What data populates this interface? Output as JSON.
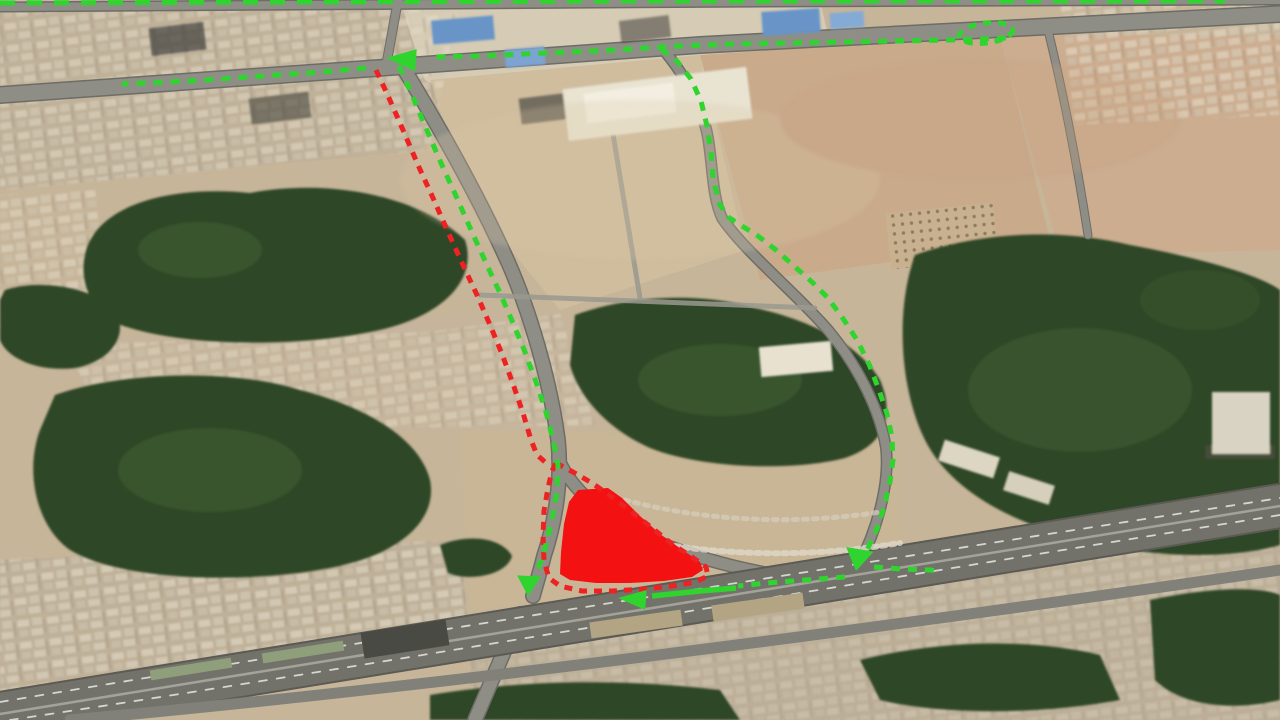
{
  "map_view": {
    "kind": "aerial-satellite-traffic-diversion-map",
    "annotations": {
      "palette": {
        "detour": "#2fd42f",
        "closed": "#ee2222",
        "closure_fill": "#f31111"
      },
      "routes": [
        {
          "id": "detour-top-edge-route",
          "color": "detour",
          "width": 5,
          "dash": [
            15,
            12
          ],
          "points": [
            [
              0,
              3
            ],
            [
              320,
              2
            ],
            [
              640,
              1
            ],
            [
              960,
              1
            ],
            [
              1225,
              1
            ]
          ]
        },
        {
          "id": "detour-westbound-approach",
          "color": "detour",
          "width": 5,
          "dash": [
            9,
            8
          ],
          "points": [
            [
              1006,
              38
            ],
            [
              952,
              40
            ],
            [
              898,
              41
            ],
            [
              845,
              42
            ],
            [
              790,
              43
            ],
            [
              735,
              44
            ],
            [
              680,
              46
            ],
            [
              660,
              47
            ],
            [
              615,
              50
            ],
            [
              570,
              52
            ],
            [
              525,
              54
            ],
            [
              480,
              56
            ],
            [
              432,
              57
            ]
          ]
        },
        {
          "id": "detour-westbound-exit",
          "color": "detour",
          "width": 5,
          "dash": [
            9,
            8
          ],
          "points": [
            [
              366,
              68
            ],
            [
              322,
              72
            ],
            [
              278,
              75
            ],
            [
              234,
              78
            ],
            [
              190,
              81
            ],
            [
              146,
              83
            ],
            [
              122,
              84
            ]
          ]
        },
        {
          "id": "detour-eastern-bypass",
          "color": "detour",
          "width": 5,
          "dash": [
            9,
            8
          ],
          "points": [
            [
              661,
              49
            ],
            [
              677,
              61
            ],
            [
              691,
              79
            ],
            [
              701,
              101
            ],
            [
              707,
              126
            ],
            [
              711,
              152
            ],
            [
              713,
              178
            ],
            [
              719,
              203
            ],
            [
              728,
              217
            ],
            [
              742,
              226
            ],
            [
              758,
              236
            ],
            [
              776,
              250
            ],
            [
              794,
              266
            ],
            [
              812,
              282
            ],
            [
              827,
              297
            ],
            [
              842,
              317
            ],
            [
              857,
              340
            ],
            [
              869,
              364
            ],
            [
              879,
              390
            ],
            [
              887,
              414
            ],
            [
              892,
              437
            ],
            [
              893,
              460
            ],
            [
              890,
              482
            ],
            [
              884,
              507
            ],
            [
              877,
              529
            ],
            [
              867,
              550
            ],
            [
              860,
              561
            ]
          ]
        },
        {
          "id": "detour-frontage-west",
          "color": "detour",
          "width": 5,
          "dash": [
            9,
            8
          ],
          "points": [
            [
              845,
              577
            ],
            [
              806,
              580
            ],
            [
              767,
              583
            ],
            [
              738,
              586
            ]
          ]
        },
        {
          "id": "detour-frontage-arrow-shaft",
          "color": "detour",
          "width": 5.5,
          "dash": null,
          "points": [
            [
              736,
              588
            ],
            [
              700,
              591
            ],
            [
              652,
              596
            ]
          ]
        },
        {
          "id": "detour-highway-east-stub",
          "color": "detour",
          "width": 5,
          "dash": [
            9,
            8
          ],
          "points": [
            [
              874,
              567
            ],
            [
              902,
              569
            ],
            [
              930,
              570
            ],
            [
              938,
              571
            ]
          ]
        },
        {
          "id": "detour-closed-road-southbound",
          "color": "detour",
          "width": 5,
          "dash": [
            9,
            8
          ],
          "points": [
            [
              399,
              66
            ],
            [
              412,
              95
            ],
            [
              426,
              128
            ],
            [
              441,
              163
            ],
            [
              456,
              196
            ],
            [
              471,
              230
            ],
            [
              486,
              263
            ],
            [
              500,
              293
            ],
            [
              513,
              323
            ],
            [
              525,
              352
            ],
            [
              536,
              382
            ],
            [
              546,
              412
            ],
            [
              553,
              440
            ],
            [
              558,
              465
            ],
            [
              557,
              492
            ],
            [
              552,
              520
            ],
            [
              545,
              548
            ],
            [
              538,
              570
            ],
            [
              534,
              581
            ]
          ]
        },
        {
          "id": "closed-road-route",
          "color": "closed",
          "width": 5,
          "dash": [
            8,
            7
          ],
          "points": [
            [
              376,
              70
            ],
            [
              389,
              98
            ],
            [
              403,
              130
            ],
            [
              418,
              165
            ],
            [
              433,
              198
            ],
            [
              448,
              232
            ],
            [
              463,
              265
            ],
            [
              477,
              295
            ],
            [
              490,
              325
            ],
            [
              502,
              354
            ],
            [
              513,
              384
            ],
            [
              523,
              413
            ],
            [
              531,
              440
            ],
            [
              537,
              455
            ],
            [
              545,
              462
            ]
          ]
        },
        {
          "id": "closure-zone-perimeter",
          "color": "closed",
          "width": 5,
          "dash": [
            8,
            7
          ],
          "closed": true,
          "points": [
            [
              556,
              463
            ],
            [
              573,
              472
            ],
            [
              592,
              483
            ],
            [
              612,
              497
            ],
            [
              633,
              513
            ],
            [
              652,
              528
            ],
            [
              672,
              544
            ],
            [
              692,
              557
            ],
            [
              706,
              567
            ],
            [
              708,
              576
            ],
            [
              695,
              582
            ],
            [
              672,
              586
            ],
            [
              645,
              589
            ],
            [
              612,
              591
            ],
            [
              582,
              591
            ],
            [
              560,
              586
            ],
            [
              549,
              578
            ],
            [
              544,
              561
            ],
            [
              543,
              536
            ],
            [
              544,
              511
            ],
            [
              548,
              488
            ],
            [
              552,
              471
            ]
          ]
        }
      ],
      "closure_area": {
        "id": "closed-zone-fill",
        "color": "closure_fill",
        "points": [
          [
            578,
            490
          ],
          [
            608,
            488
          ],
          [
            622,
            498
          ],
          [
            640,
            516
          ],
          [
            660,
            534
          ],
          [
            684,
            551
          ],
          [
            700,
            562
          ],
          [
            703,
            570
          ],
          [
            692,
            577
          ],
          [
            664,
            581
          ],
          [
            630,
            583
          ],
          [
            596,
            583
          ],
          [
            570,
            580
          ],
          [
            560,
            574
          ],
          [
            561,
            552
          ],
          [
            564,
            524
          ],
          [
            569,
            502
          ]
        ]
      },
      "uturn_loop": {
        "id": "u-turn-loop",
        "color": "detour",
        "width": 5,
        "dash": [
          8,
          7
        ],
        "cx": 986,
        "cy": 33,
        "rx": 27,
        "ry": 10,
        "rotate": -7
      },
      "arrows": [
        {
          "id": "arrow-west-top-intersection",
          "color": "detour",
          "x": 386,
          "y": 58,
          "angle": 184,
          "len": 30,
          "halfwidth": 11
        },
        {
          "id": "arrow-south-bottom-junction",
          "color": "detour",
          "x": 528,
          "y": 596,
          "angle": 93,
          "len": 20,
          "halfwidth": 12
        },
        {
          "id": "arrow-south-highway-junction",
          "color": "detour",
          "x": 856,
          "y": 571,
          "angle": 100,
          "len": 22,
          "halfwidth": 14
        },
        {
          "id": "arrow-west-frontage-road",
          "color": "detour",
          "x": 618,
          "y": 598,
          "angle": 184,
          "len": 28,
          "halfwidth": 10
        }
      ]
    }
  }
}
